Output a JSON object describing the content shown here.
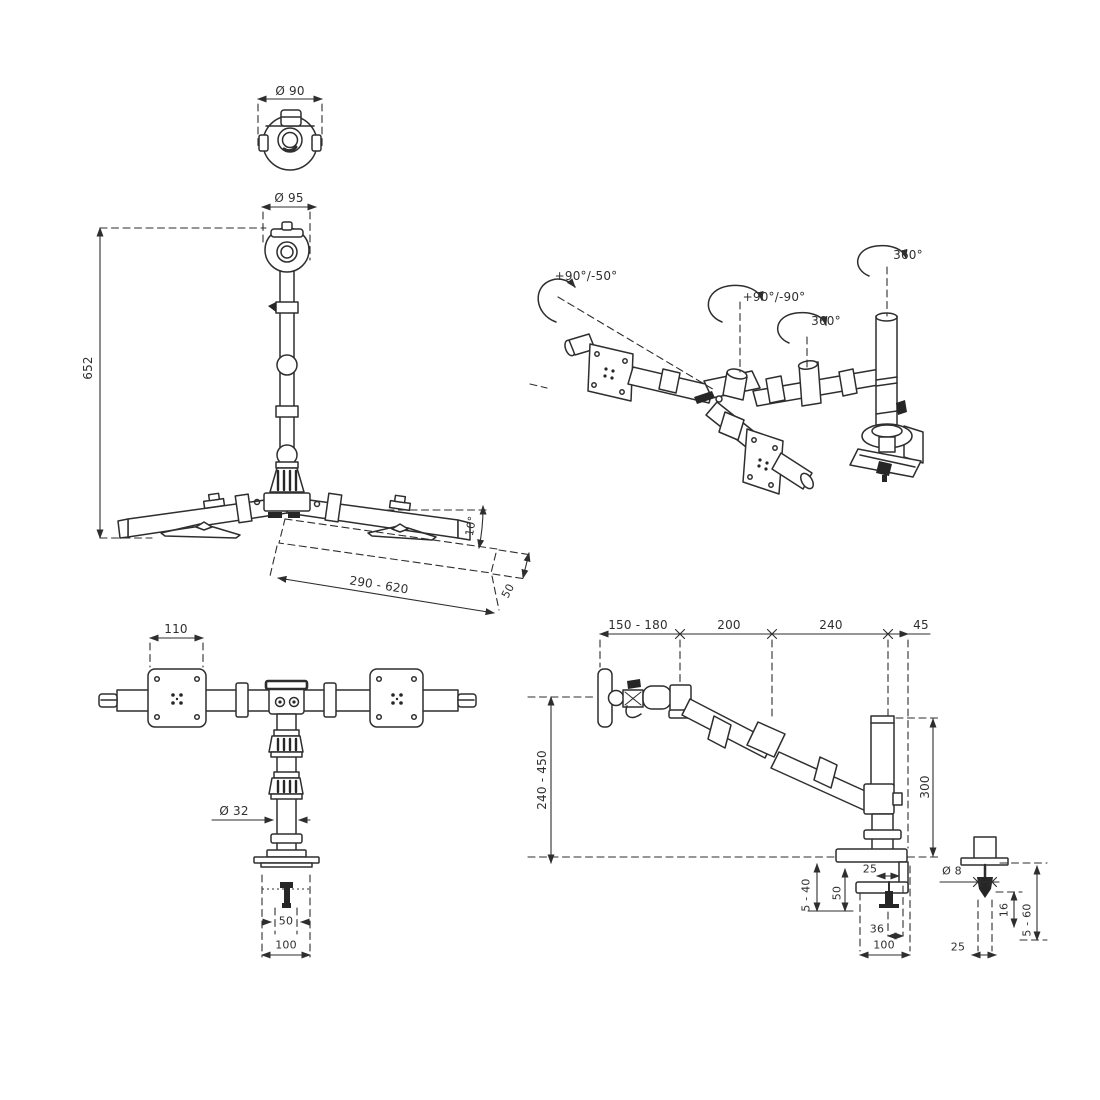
{
  "palette": {
    "background": "#ffffff",
    "line": "#2e2e2e",
    "text": "#2f2f2f"
  },
  "views": {
    "top_view": {
      "labels": {
        "diameter": "Ø 90"
      }
    },
    "front_view": {
      "labels": {
        "head_diameter": "Ø 95",
        "column_height": "652",
        "arm_reach": "290 - 620",
        "tilt_angle": "10°",
        "arm_drop": "50"
      }
    },
    "iso_view": {
      "labels": {
        "tilt_range": "+90°/-50°",
        "pivot_range": "+90°/-90°",
        "arm_rotation": "360°",
        "base_rotation": "360°"
      }
    },
    "bottom_front_view": {
      "labels": {
        "vesa_width": "110",
        "pole_diameter": "Ø 32",
        "clamp_depth": "50",
        "clamp_width": "100"
      }
    },
    "side_view": {
      "labels": {
        "depth_seg1": "150 - 180",
        "depth_seg2": "200",
        "depth_seg3": "240",
        "depth_seg4": "45",
        "height_range": "240 - 450",
        "pole_height": "300",
        "clamp_jaw": "25",
        "clamp_inner_height": "50",
        "desk_thickness": "5 - 40",
        "bolt_offset": "36",
        "clamp_width": "100",
        "bolt_diameter": "Ø 8",
        "sleeve_length": "16",
        "grommet_thickness": "5 - 60",
        "grommet_width": "25"
      }
    }
  }
}
